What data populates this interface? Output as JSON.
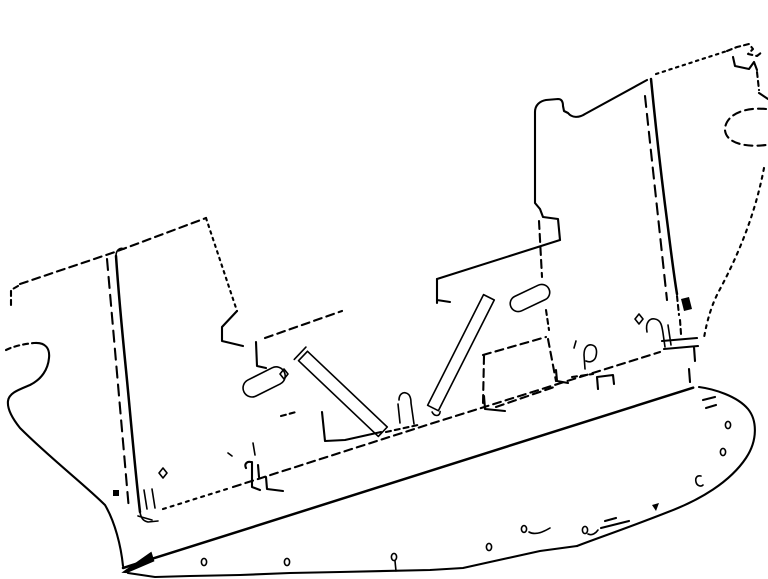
{
  "figure": {
    "type": "line-drawing",
    "description": "Monochrome perspective line drawing of a vehicle rear bulkhead / floor panel: dashed hidden-edge outlines, a stepped top profile with two pillars, two diagonal cross-hatched braces, corrugated rib brackets, a long hatched sill rail and a rounded lower flange pierced by small oval holes",
    "background_color": "#ffffff",
    "line_color": "#000000"
  },
  "parts": {
    "left_panel": "left panel outline",
    "top_profile": "stepped top edge profile",
    "center_pillar": "center pillar",
    "right_pillar": "right pillar",
    "right_edge": "right edge and corner bracket",
    "brace_left": "left diagonal ribbed brace",
    "brace_right": "right diagonal ribbed brace",
    "rib_bracket_left": "left corrugated rib bracket",
    "rib_bracket_right": "right corrugated rib bracket",
    "corrugated_band": "corrugated flange band",
    "sill_rail": "hatched sill rail",
    "lower_flange": "rounded lower flange with holes",
    "hidden_lines": "interior hidden lines and clips"
  }
}
